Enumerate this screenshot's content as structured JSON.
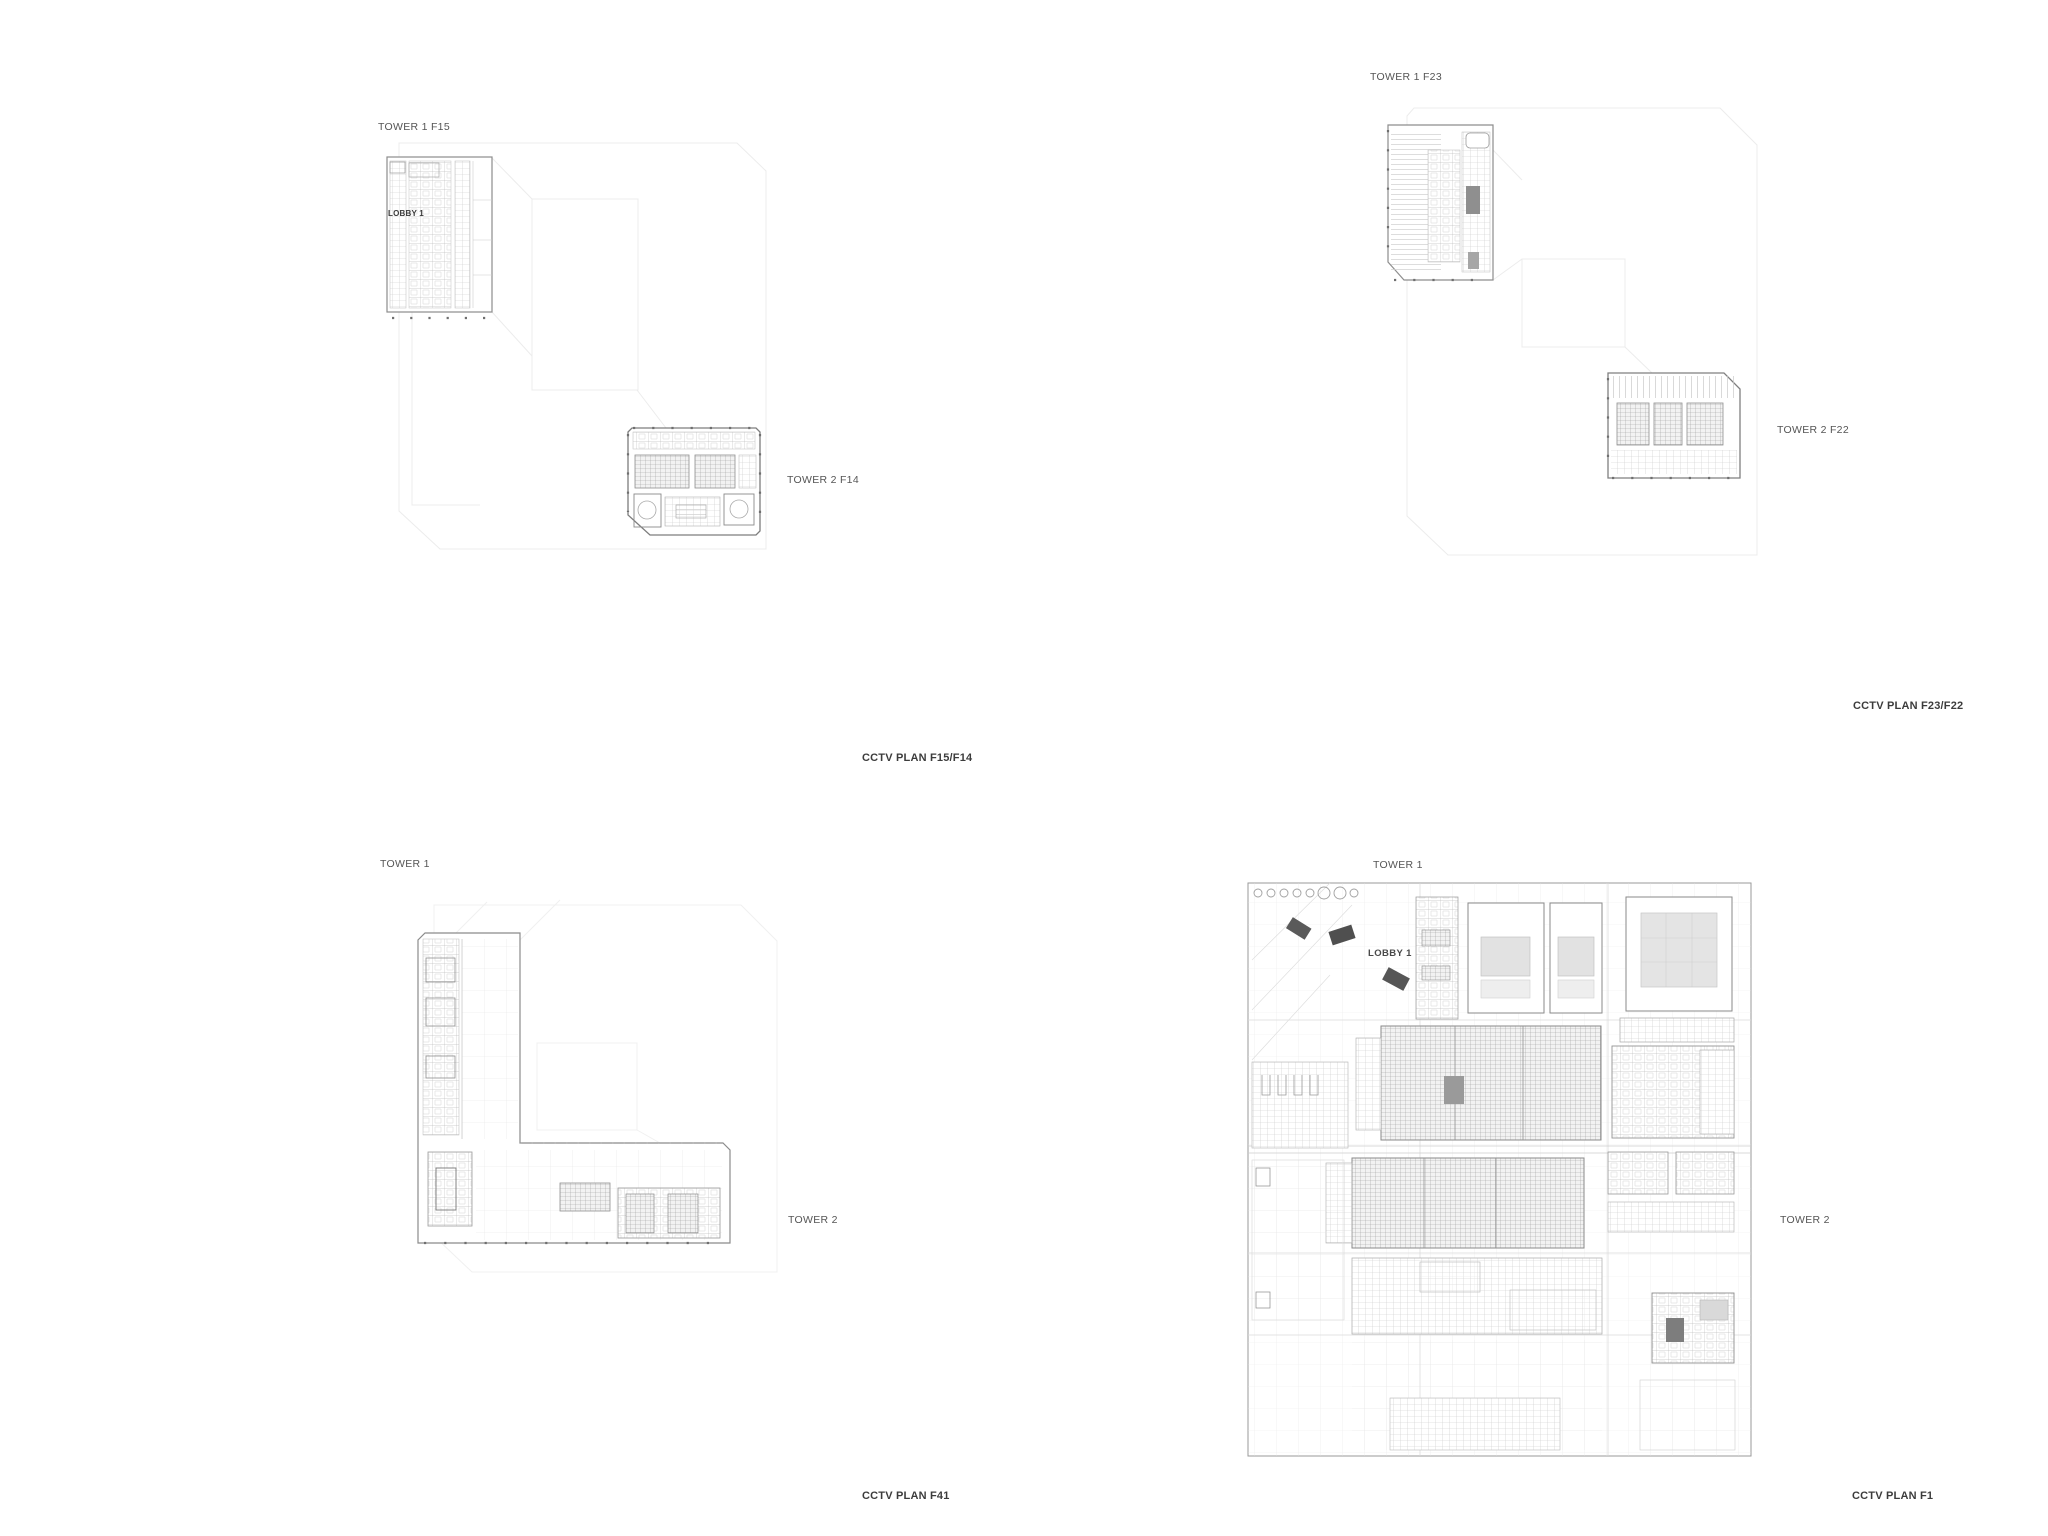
{
  "sheet": {
    "title": "CCTV floor plan drawing sheet",
    "colors": {
      "background": "#ffffff",
      "plan_ink": "#8a8a8a",
      "plan_faint": "#ececec",
      "plan_detail": "#c2c2c2",
      "core_dark": "#565656",
      "studio_fill": "#e2e2e2",
      "label": "#555555",
      "caption": "#3c3c3c"
    }
  },
  "panels": [
    {
      "id": "f15-f14",
      "tower1_label": "TOWER 1 F15",
      "tower2_label": "TOWER 2 F14",
      "lobby_label": "LOBBY 1",
      "caption": "CCTV PLAN F15/F14"
    },
    {
      "id": "f23-f22",
      "tower1_label": "TOWER 1 F23",
      "tower2_label": "TOWER 2 F22",
      "caption": "CCTV PLAN F23/F22"
    },
    {
      "id": "f41",
      "tower1_label": "TOWER 1",
      "tower2_label": "TOWER 2",
      "caption": "CCTV PLAN F41"
    },
    {
      "id": "f1",
      "tower1_label": "TOWER 1",
      "tower2_label": "TOWER 2",
      "lobby_label": "LOBBY 1",
      "caption": "CCTV PLAN F1"
    }
  ]
}
